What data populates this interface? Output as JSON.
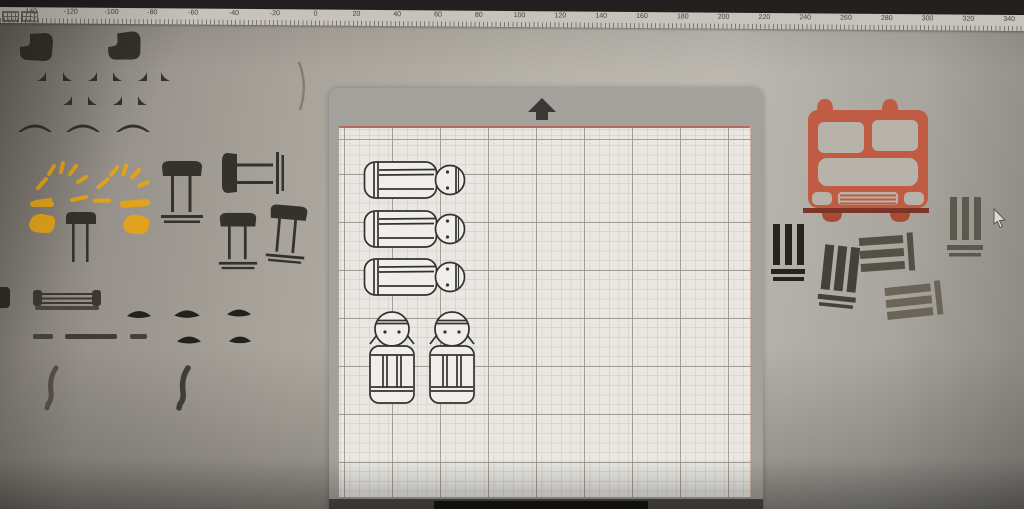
{
  "ruler": {
    "labels": [
      "-140",
      "-120",
      "-100",
      "-80",
      "-60",
      "-40",
      "-20",
      "0",
      "20",
      "40",
      "60",
      "80",
      "100",
      "120",
      "140",
      "160",
      "180",
      "200",
      "220",
      "240",
      "260",
      "280",
      "300",
      "320",
      "340"
    ],
    "unit_step": 20
  },
  "mat": {
    "arrow_icon": "up-arrow",
    "grid": true,
    "items": {
      "lying_peg_dolls": 3,
      "standing_peg_dolls": 2
    }
  },
  "canvas": {
    "left_shapes": [
      "hair-blob",
      "corner-triangle",
      "smile-arc",
      "sun-rays",
      "highlight-bar",
      "paint-blob",
      "stool-table",
      "rolling-pin",
      "lens-oval",
      "dash-bar",
      "curved-bracket"
    ],
    "right_shapes": [
      "fire-truck-front",
      "stripe-group"
    ],
    "stripe_group_count": 5,
    "table_count": 5
  },
  "cursor": {
    "icon": "mouse-pointer"
  },
  "colors": {
    "top_bar": "#23211f",
    "ruler_bg": "#c7c3bb",
    "canvas_bg": "#b2aea5",
    "mat_frame": "#a3a19b",
    "mat_grid_bg": "#e9e8e3",
    "grid_minor": "#d9d7d1",
    "grid_major": "#a19e96",
    "grid_red": "#b76a5c",
    "outline_ink": "#34322e",
    "shape_dark": "#35322b",
    "ray_yellow": "#e2a31c",
    "truck_orange": "#c05c43",
    "truck_dark": "#7c3426"
  }
}
